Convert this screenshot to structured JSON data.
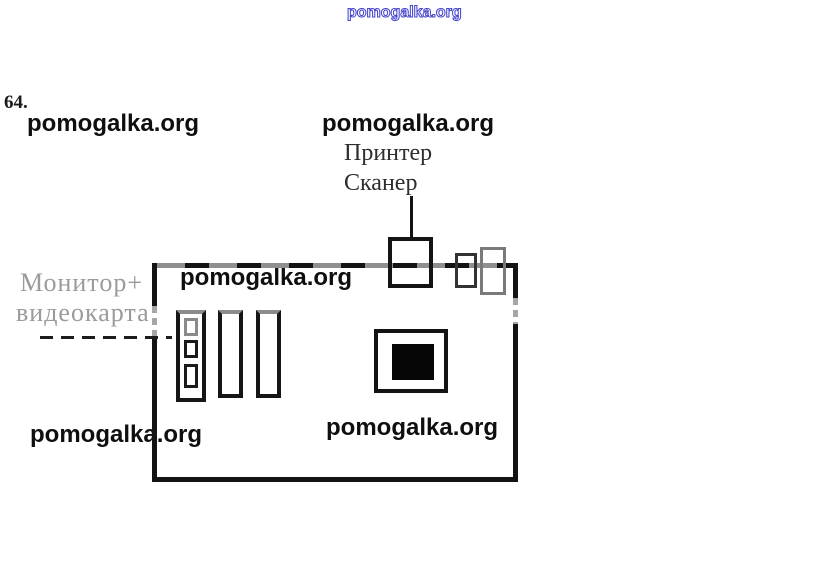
{
  "exercise": {
    "number": "64."
  },
  "watermark": {
    "text": "pomogalka.org",
    "blue_color": "#4444cc",
    "ink_color": "#0f0f0f"
  },
  "labels": {
    "printer": "Принтер",
    "scanner": "Сканер",
    "monitor_plus": "Монитор+",
    "videocard": "видеокарта"
  },
  "diagram": {
    "type": "motherboard-schematic",
    "components": {
      "board": "motherboard-outline",
      "slots": 3,
      "cpu_socket": 1,
      "top_ports": 3
    }
  },
  "colors": {
    "ink": "#141414",
    "faded_label": "#9b9b9b",
    "scan_gray": "#8f8f8f"
  }
}
